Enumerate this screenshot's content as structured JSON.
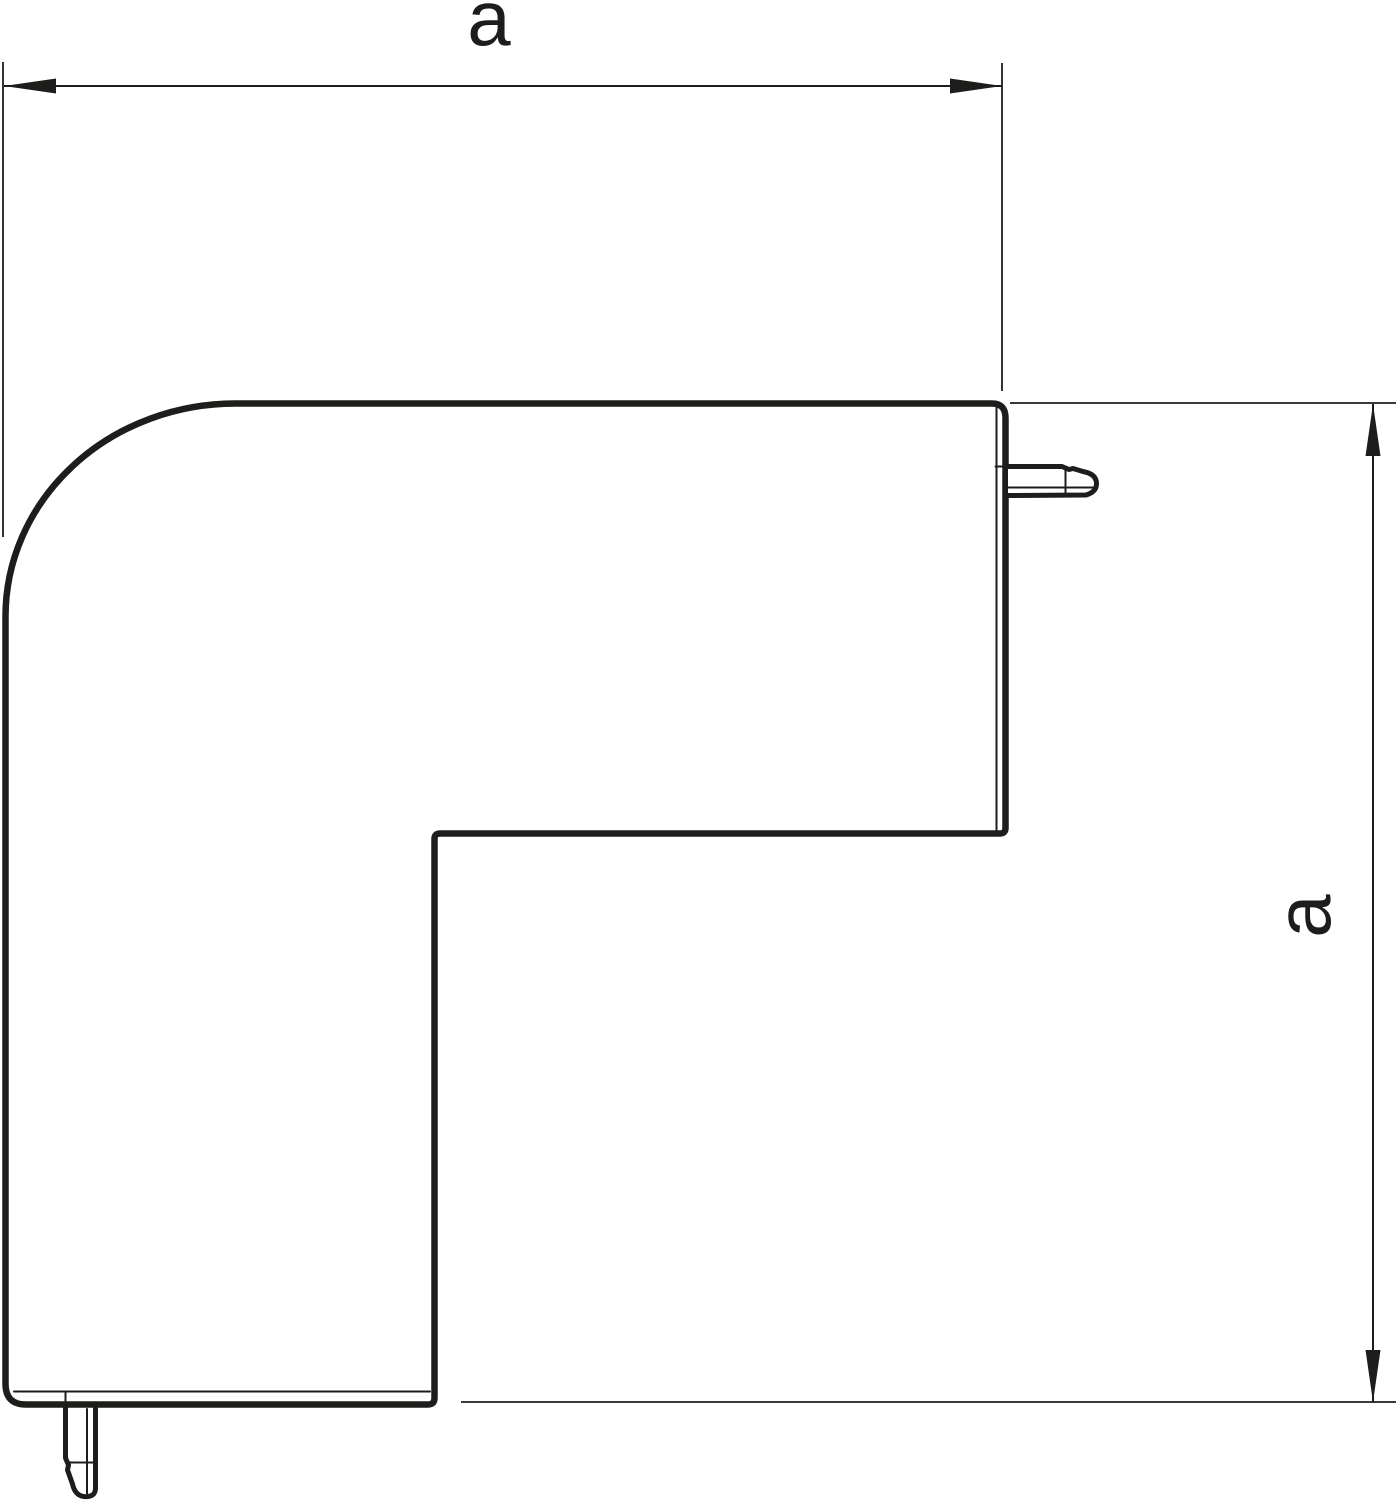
{
  "drawing": {
    "background_color": "#ffffff",
    "line_color": "#1d1d1b",
    "part": {
      "name": "corner-piece-profile"
    },
    "dimensions": [
      {
        "id": "width",
        "label": "a",
        "orientation": "horizontal"
      },
      {
        "id": "height",
        "label": "a",
        "orientation": "vertical"
      }
    ]
  }
}
